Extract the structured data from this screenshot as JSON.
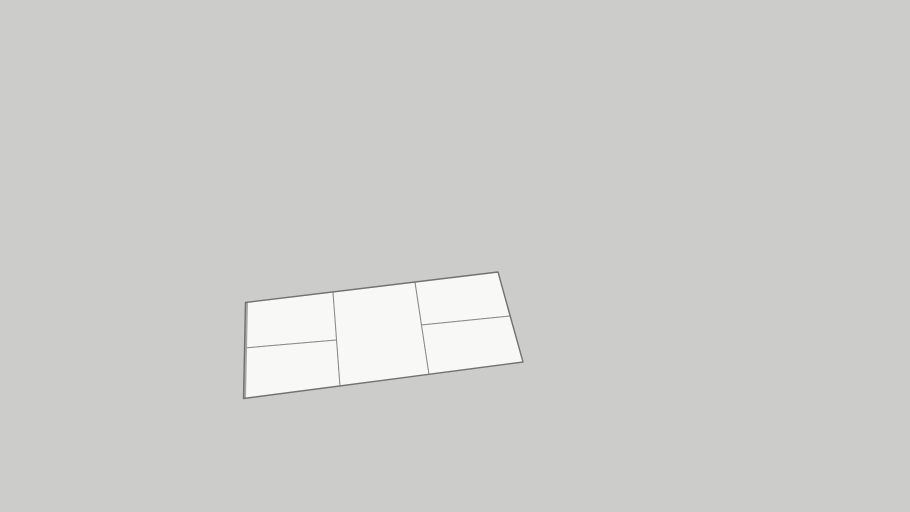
{
  "viewport": {
    "type": "3d-model-viewport",
    "width": 910,
    "height": 512,
    "background_color": "#cccccb"
  },
  "model": {
    "name": "subdivided-rectangular-slab",
    "face_color": "#f8f8f7",
    "outer_edge_color": "#6e6e6c",
    "inner_edge_color": "#8b8b89",
    "side_face_color": "#a7a7a5",
    "outer_edge_width": 1.4,
    "inner_edge_width": 1,
    "outline_points": "245.5,302.5 498,272 523,362 243.5,398.5",
    "faces": [
      {
        "id": "panel-left-top",
        "points": "245.5,302.5 333,292 336.6,340 244.6,348"
      },
      {
        "id": "panel-left-bottom",
        "points": "244.6,348 336.6,340 340,386 243.5,398.5"
      },
      {
        "id": "panel-middle",
        "points": "333,292 415,282 429,374.3 340,386"
      },
      {
        "id": "panel-right-top",
        "points": "415,282 498,272 510,316 421.5,325"
      },
      {
        "id": "panel-right-bottom",
        "points": "421.5,325 510,316 523,362 429,374.3"
      }
    ],
    "side_strip_points": "245.5,302.5 248,302.2 246,398.2 243.5,398.5"
  }
}
